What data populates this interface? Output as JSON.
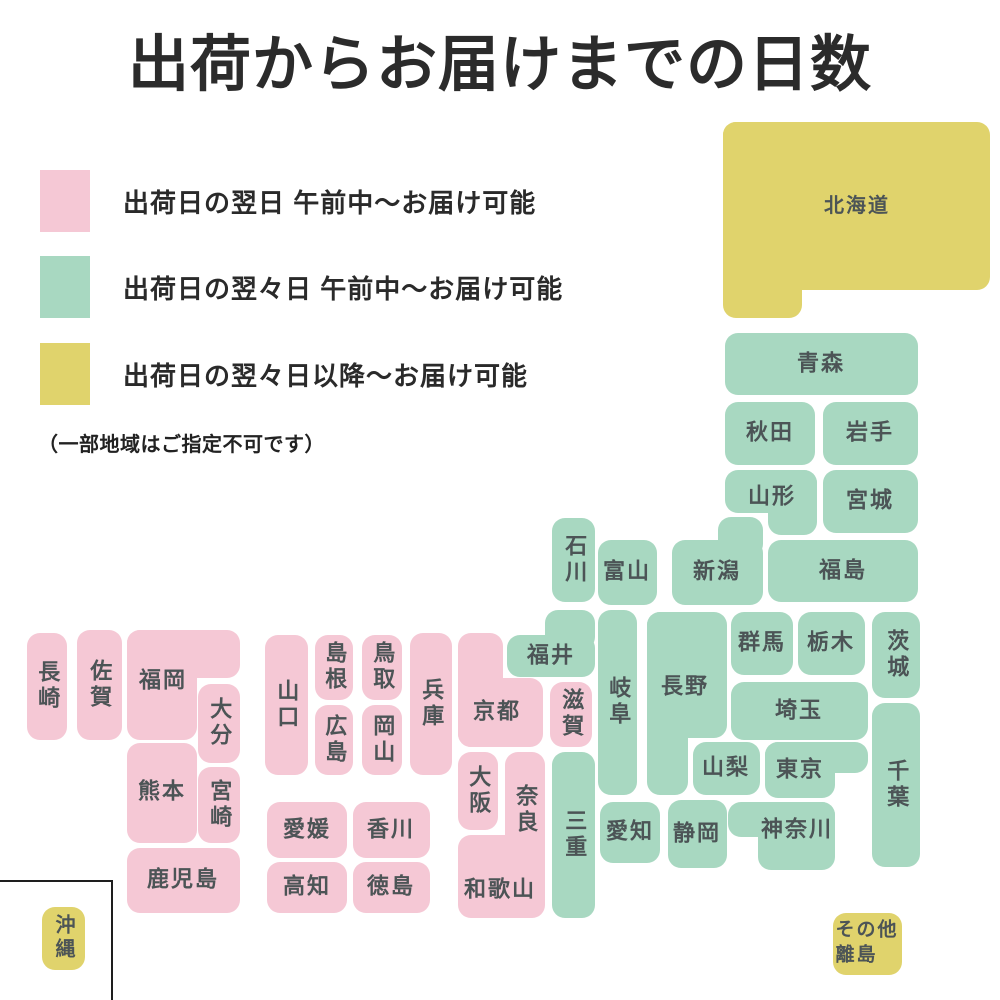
{
  "title": "出荷からお届けまでの日数",
  "note": "（一部地域はご指定不可です）",
  "colors": {
    "next_day": "#F5C8D5",
    "two_days": "#A8D8C1",
    "two_days_plus": "#E0D36C"
  },
  "legend": {
    "items": [
      {
        "key": "next_day",
        "label": "出荷日の翌日 午前中〜お届け可能",
        "y": 170
      },
      {
        "key": "two_days",
        "label": "出荷日の翌々日 午前中〜お届け可能",
        "y": 256
      },
      {
        "key": "two_days_plus",
        "label": "出荷日の翌々日以降〜お届け可能",
        "y": 343
      }
    ]
  },
  "map": {
    "okinawa_frame": {
      "x": -4,
      "y": 880,
      "w": 117,
      "h": 130
    },
    "blocks": [
      {
        "id": "hokkaido",
        "label": "北海道",
        "key": "two_days_plus",
        "rects": [
          [
            723,
            122,
            267,
            168
          ],
          [
            723,
            122,
            79,
            196
          ]
        ],
        "lx": 857,
        "ly": 206,
        "fs": 20
      },
      {
        "id": "aomori",
        "label": "青森",
        "key": "two_days",
        "rects": [
          [
            725,
            333,
            193,
            62
          ]
        ],
        "lx": 821,
        "ly": 364
      },
      {
        "id": "akita",
        "label": "秋田",
        "key": "two_days",
        "rects": [
          [
            725,
            402,
            90,
            63
          ]
        ],
        "lx": 770,
        "ly": 433
      },
      {
        "id": "iwate",
        "label": "岩手",
        "key": "two_days",
        "rects": [
          [
            823,
            402,
            95,
            63
          ]
        ],
        "lx": 870,
        "ly": 433
      },
      {
        "id": "yamagata",
        "label": "山形",
        "key": "two_days",
        "rects": [
          [
            725,
            470,
            92,
            43
          ],
          [
            768,
            470,
            49,
            65
          ]
        ],
        "lx": 772,
        "ly": 497
      },
      {
        "id": "miyagi",
        "label": "宮城",
        "key": "two_days",
        "rects": [
          [
            823,
            470,
            95,
            63
          ]
        ],
        "lx": 870,
        "ly": 501
      },
      {
        "id": "fukushima",
        "label": "福島",
        "key": "two_days",
        "rects": [
          [
            768,
            540,
            150,
            62
          ]
        ],
        "lx": 843,
        "ly": 571
      },
      {
        "id": "niigata",
        "label": "新潟",
        "key": "two_days",
        "rects": [
          [
            672,
            540,
            91,
            65
          ],
          [
            718,
            517,
            45,
            40
          ]
        ],
        "lx": 717,
        "ly": 572
      },
      {
        "id": "toyama",
        "label": "富山",
        "key": "two_days",
        "rects": [
          [
            598,
            540,
            59,
            65
          ]
        ],
        "lx": 627,
        "ly": 572
      },
      {
        "id": "ishikawa",
        "label": "石川",
        "key": "two_days",
        "v": true,
        "rects": [
          [
            552,
            518,
            43,
            84
          ]
        ],
        "lx": 574,
        "ly": 560
      },
      {
        "id": "fukui",
        "label": "福井",
        "key": "two_days",
        "rects": [
          [
            507,
            635,
            88,
            42
          ],
          [
            545,
            610,
            50,
            40
          ]
        ],
        "lx": 551,
        "ly": 656
      },
      {
        "id": "nagano",
        "label": "長野",
        "key": "two_days",
        "rects": [
          [
            647,
            612,
            80,
            126
          ],
          [
            647,
            612,
            41,
            183
          ]
        ],
        "lx": 685,
        "ly": 687
      },
      {
        "id": "gifu",
        "label": "岐阜",
        "key": "two_days",
        "v": true,
        "rects": [
          [
            598,
            610,
            39,
            185
          ]
        ],
        "lx": 618,
        "ly": 702
      },
      {
        "id": "gunma",
        "label": "群馬",
        "key": "two_days",
        "rects": [
          [
            731,
            612,
            62,
            63
          ]
        ],
        "lx": 762,
        "ly": 643
      },
      {
        "id": "tochigi",
        "label": "栃木",
        "key": "two_days",
        "rects": [
          [
            798,
            612,
            67,
            63
          ]
        ],
        "lx": 831,
        "ly": 643
      },
      {
        "id": "ibaraki",
        "label": "茨城",
        "key": "two_days",
        "v": true,
        "rects": [
          [
            872,
            612,
            48,
            86
          ]
        ],
        "lx": 896,
        "ly": 655
      },
      {
        "id": "saitama",
        "label": "埼玉",
        "key": "two_days",
        "rects": [
          [
            731,
            682,
            137,
            58
          ]
        ],
        "lx": 799,
        "ly": 711
      },
      {
        "id": "yamanashi",
        "label": "山梨",
        "key": "two_days",
        "rects": [
          [
            693,
            742,
            67,
            53
          ]
        ],
        "lx": 726,
        "ly": 768
      },
      {
        "id": "tokyo",
        "label": "東京",
        "key": "two_days",
        "rects": [
          [
            765,
            742,
            70,
            56
          ],
          [
            765,
            742,
            103,
            31
          ]
        ],
        "lx": 800,
        "ly": 770
      },
      {
        "id": "chiba",
        "label": "千葉",
        "key": "two_days",
        "v": true,
        "rects": [
          [
            872,
            703,
            48,
            164
          ]
        ],
        "lx": 896,
        "ly": 785
      },
      {
        "id": "kanagawa",
        "label": "神奈川",
        "key": "two_days",
        "rects": [
          [
            728,
            802,
            107,
            35
          ],
          [
            758,
            802,
            77,
            68
          ]
        ],
        "lx": 797,
        "ly": 830
      },
      {
        "id": "shizuoka",
        "label": "静岡",
        "key": "two_days",
        "rects": [
          [
            668,
            800,
            59,
            68
          ]
        ],
        "lx": 697,
        "ly": 834
      },
      {
        "id": "aichi",
        "label": "愛知",
        "key": "two_days",
        "rects": [
          [
            600,
            802,
            60,
            61
          ]
        ],
        "lx": 630,
        "ly": 832
      },
      {
        "id": "mie",
        "label": "三重",
        "key": "two_days",
        "v": true,
        "rects": [
          [
            552,
            752,
            43,
            166
          ]
        ],
        "lx": 574,
        "ly": 835
      },
      {
        "id": "shiga",
        "label": "滋賀",
        "key": "next_day",
        "v": true,
        "rects": [
          [
            550,
            682,
            42,
            65
          ]
        ],
        "lx": 571,
        "ly": 714
      },
      {
        "id": "kyoto",
        "label": "京都",
        "key": "next_day",
        "rects": [
          [
            458,
            633,
            45,
            114
          ],
          [
            458,
            678,
            85,
            69
          ]
        ],
        "lx": 497,
        "ly": 712
      },
      {
        "id": "hyogo",
        "label": "兵庫",
        "key": "next_day",
        "v": true,
        "rects": [
          [
            410,
            633,
            42,
            142
          ]
        ],
        "lx": 431,
        "ly": 704
      },
      {
        "id": "osaka",
        "label": "大阪",
        "key": "next_day",
        "v": true,
        "rects": [
          [
            458,
            752,
            40,
            78
          ]
        ],
        "lx": 478,
        "ly": 791
      },
      {
        "id": "nara",
        "label": "奈良",
        "key": "next_day",
        "v": true,
        "rects": [
          [
            505,
            752,
            40,
            116
          ]
        ],
        "lx": 525,
        "ly": 810
      },
      {
        "id": "wakayama",
        "label": "和歌山",
        "key": "next_day",
        "rects": [
          [
            458,
            835,
            87,
            83
          ]
        ],
        "lx": 500,
        "ly": 890
      },
      {
        "id": "tottori",
        "label": "鳥取",
        "key": "next_day",
        "v": true,
        "rects": [
          [
            362,
            635,
            40,
            65
          ]
        ],
        "lx": 382,
        "ly": 667
      },
      {
        "id": "okayama",
        "label": "岡山",
        "key": "next_day",
        "v": true,
        "rects": [
          [
            362,
            705,
            40,
            70
          ]
        ],
        "lx": 382,
        "ly": 740
      },
      {
        "id": "shimane",
        "label": "島根",
        "key": "next_day",
        "v": true,
        "rects": [
          [
            315,
            635,
            38,
            65
          ]
        ],
        "lx": 334,
        "ly": 667
      },
      {
        "id": "hiroshima",
        "label": "広島",
        "key": "next_day",
        "v": true,
        "rects": [
          [
            315,
            705,
            38,
            70
          ]
        ],
        "lx": 334,
        "ly": 740
      },
      {
        "id": "yamaguchi",
        "label": "山口",
        "key": "next_day",
        "v": true,
        "rects": [
          [
            265,
            635,
            43,
            140
          ]
        ],
        "lx": 286,
        "ly": 705
      },
      {
        "id": "ehime",
        "label": "愛媛",
        "key": "next_day",
        "rects": [
          [
            267,
            802,
            80,
            56
          ]
        ],
        "lx": 307,
        "ly": 830
      },
      {
        "id": "kagawa",
        "label": "香川",
        "key": "next_day",
        "rects": [
          [
            353,
            802,
            77,
            56
          ]
        ],
        "lx": 391,
        "ly": 830
      },
      {
        "id": "kochi",
        "label": "高知",
        "key": "next_day",
        "rects": [
          [
            267,
            862,
            80,
            51
          ]
        ],
        "lx": 307,
        "ly": 887
      },
      {
        "id": "tokushima",
        "label": "徳島",
        "key": "next_day",
        "rects": [
          [
            353,
            862,
            77,
            51
          ]
        ],
        "lx": 391,
        "ly": 887
      },
      {
        "id": "fukuoka",
        "label": "福岡",
        "key": "next_day",
        "rects": [
          [
            127,
            630,
            113,
            48
          ],
          [
            127,
            630,
            70,
            110
          ]
        ],
        "lx": 163,
        "ly": 681
      },
      {
        "id": "saga",
        "label": "佐賀",
        "key": "next_day",
        "v": true,
        "rects": [
          [
            77,
            630,
            45,
            110
          ]
        ],
        "lx": 99,
        "ly": 685
      },
      {
        "id": "nagasaki",
        "label": "長崎",
        "key": "next_day",
        "v": true,
        "rects": [
          [
            27,
            633,
            40,
            107
          ]
        ],
        "lx": 47,
        "ly": 686
      },
      {
        "id": "oita",
        "label": "大分",
        "key": "next_day",
        "v": true,
        "rects": [
          [
            198,
            684,
            42,
            79
          ]
        ],
        "lx": 219,
        "ly": 723
      },
      {
        "id": "kumamoto",
        "label": "熊本",
        "key": "next_day",
        "rects": [
          [
            127,
            743,
            70,
            100
          ]
        ],
        "lx": 162,
        "ly": 792
      },
      {
        "id": "miyazaki",
        "label": "宮崎",
        "key": "next_day",
        "v": true,
        "rects": [
          [
            198,
            767,
            42,
            76
          ]
        ],
        "lx": 219,
        "ly": 805
      },
      {
        "id": "kagoshima",
        "label": "鹿児島",
        "key": "next_day",
        "rects": [
          [
            127,
            848,
            113,
            65
          ]
        ],
        "lx": 183,
        "ly": 880
      },
      {
        "id": "okinawa",
        "label": "沖縄",
        "key": "two_days_plus",
        "v": true,
        "rects": [
          [
            42,
            907,
            43,
            63
          ]
        ],
        "lx": 63,
        "ly": 938,
        "fs": 20
      },
      {
        "id": "other-islands",
        "label": "その他離島",
        "key": "two_days_plus",
        "lines": [
          "その他",
          "離島"
        ],
        "rects": [
          [
            833,
            913,
            69,
            62
          ]
        ],
        "lx": 867,
        "ly": 943,
        "fs": 19
      }
    ]
  }
}
